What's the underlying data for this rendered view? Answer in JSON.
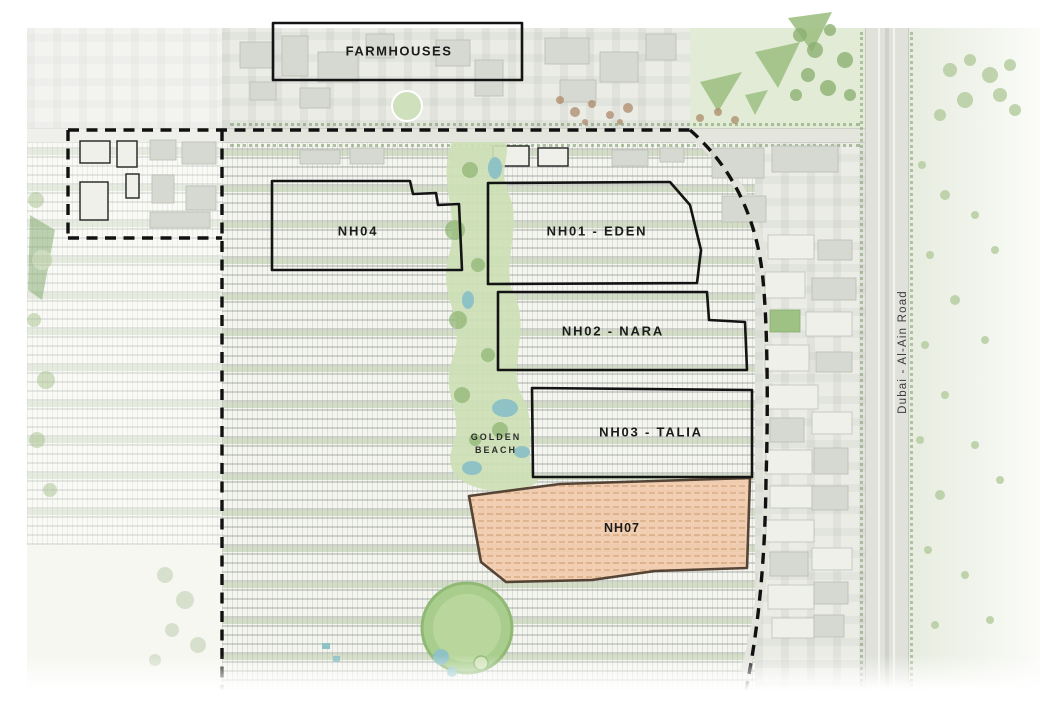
{
  "labels": {
    "farmhouses": "FARMHOUSES",
    "nh04": "NH04",
    "nh01_eden": "NH01 - EDEN",
    "nh02_nara": "NH02 - NARA",
    "nh03_talia": "NH03 - TALIA",
    "nh07": "NH07",
    "golden_beach_line1": "GOLDEN",
    "golden_beach_line2": "BEACH",
    "road": "Dubai - Al-Ain Road"
  },
  "colors": {
    "nh07_fill": "#f2cbad",
    "nh07_border": "#4a3828",
    "parcel_border": "#141414",
    "boundary_dash": "#111111",
    "park_green": "#cddfb6",
    "deep_green": "#8db470",
    "pond_teal": "#8fc2c5",
    "road_gray": "#dfe1da"
  }
}
